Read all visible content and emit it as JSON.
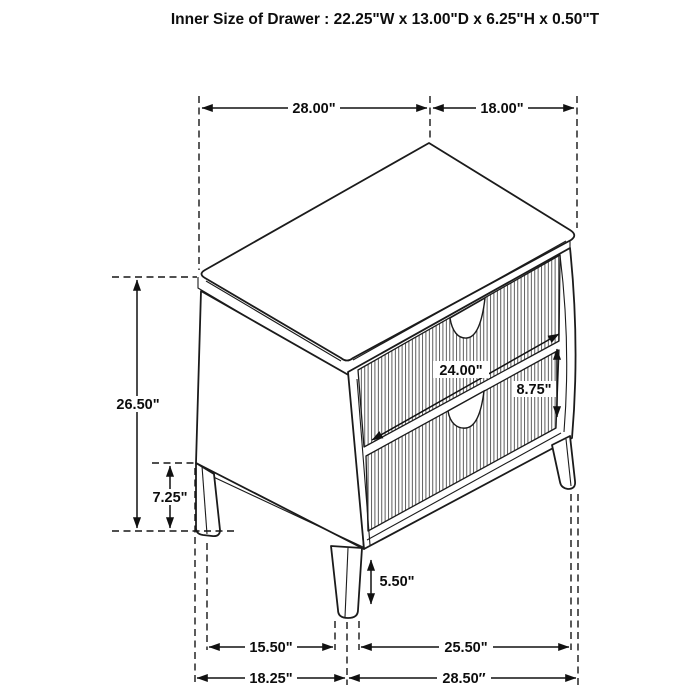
{
  "title": "Inner Size of Drawer : 22.25\"W x 13.00\"D x 6.25\"H x 0.50\"T",
  "drawing": {
    "subject": "two-drawer nightstand isometric dimension diagram",
    "line_color": "#1b1b1b",
    "background_color": "#ffffff"
  },
  "dimensions": {
    "top_width": "28.00\"",
    "top_depth": "18.00\"",
    "overall_height": "26.50\"",
    "floor_to_case_bottom": "7.25\"",
    "drawer_front_width": "24.00\"",
    "drawer_front_height": "8.75\"",
    "leg_height": "5.50\"",
    "leg_span_side": "15.50\"",
    "leg_span_front": "25.50\"",
    "base_depth": "18.25\"",
    "base_width": "28.50″"
  }
}
